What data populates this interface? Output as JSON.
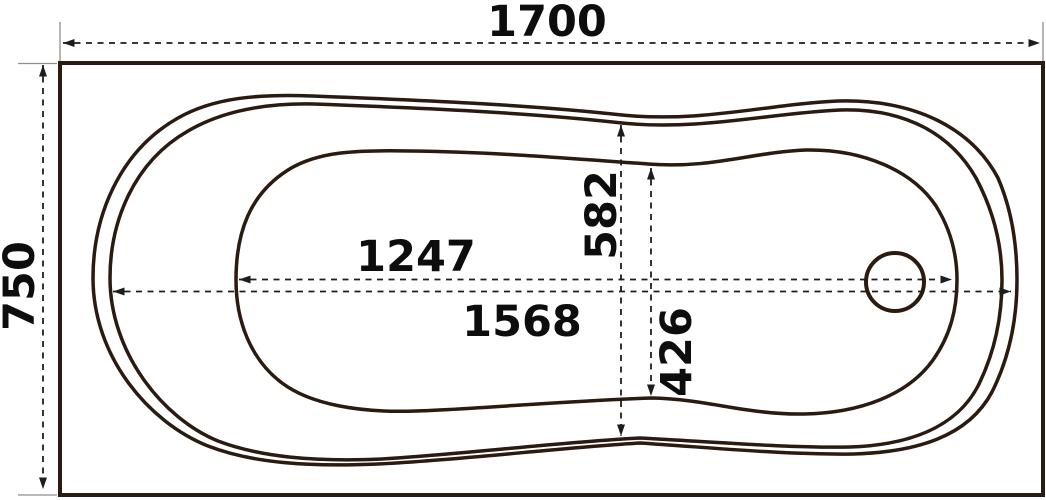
{
  "drawing": {
    "title": "bathtub-top-view-technical-drawing",
    "view": "plan (top) view of rectangular bathtub with drain",
    "units": "mm",
    "labels": {
      "overall_length": "1700",
      "overall_width": "750",
      "basin_length": "1247",
      "rim_inner_length": "1568",
      "rim_waist_width": "582",
      "basin_waist_width": "426"
    },
    "colors": {
      "outline": "#2b1a10",
      "dimension_line": "#1d1d1d",
      "extension_line": "#8f8f8f",
      "text": "#0d0d0d",
      "background": "#ffffff"
    }
  }
}
